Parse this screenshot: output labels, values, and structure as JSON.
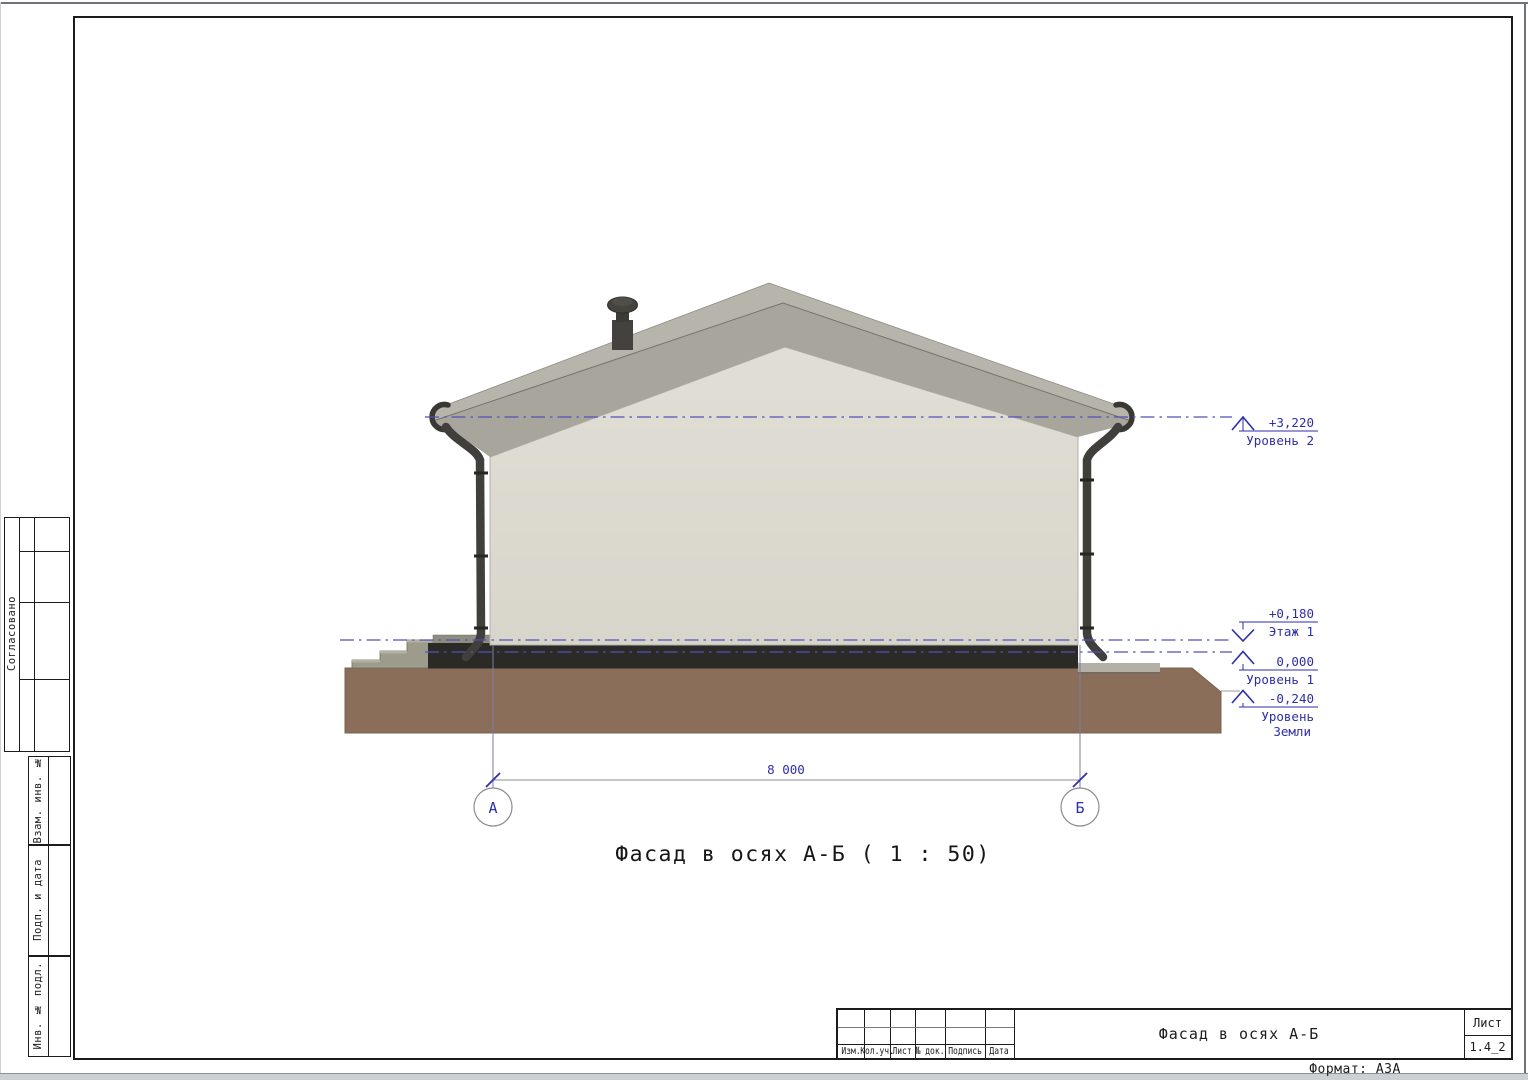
{
  "sheet": {
    "format_note": "Формат: А3А"
  },
  "drawing": {
    "view_title": "Фасад в осях А-Б ( 1 : 50)",
    "dimension_value": "8 000",
    "axes": [
      {
        "label": "А"
      },
      {
        "label": "Б"
      }
    ],
    "levels": [
      {
        "value": "+3,220",
        "name": "Уровень 2"
      },
      {
        "value": "+0,180",
        "name": "Этаж 1"
      },
      {
        "value": "0,000",
        "name": "Уровень 1"
      },
      {
        "value": "-0,240",
        "name": "Уровень",
        "name2": "Земли"
      }
    ],
    "colors": {
      "annotation": "#2e2eaa",
      "level_line": "#5252b8",
      "wall": "#dcdad0",
      "roof": "#b7b4ab",
      "roof_soffit": "#a8a59c",
      "ground": "#8b6e5a",
      "plinth": "#2b2a27"
    }
  },
  "side_stamp": {
    "approved": "Согласовано",
    "fields": [
      "Взам. инв. №",
      "Подп. и дата",
      "Инв. № подл."
    ]
  },
  "title_block": {
    "bottom_labels": [
      "Изм.",
      "Кол.уч.",
      "Лист",
      "№ док.",
      "Подпись",
      "Дата"
    ],
    "doc_title": "Фасад в осях А-Б",
    "sheet_label": "Лист",
    "sheet_number": "1.4_2"
  }
}
